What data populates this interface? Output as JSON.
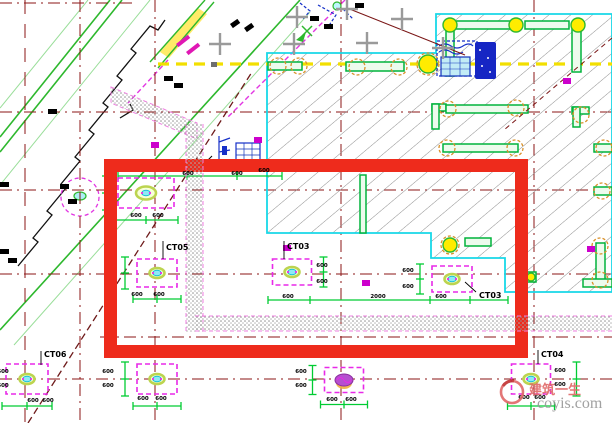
{
  "title": "Foundation pile-cap CAD plan with red highlight box",
  "watermark": {
    "cn": "建筑一生",
    "en": "coyis.com"
  },
  "colors": {
    "grid_line": "#8b1515",
    "highlight_red": "#ee2b1c",
    "wall_green": "#00b33c",
    "dim_green": "#00cc33",
    "boundary_cyan": "#17d8e8",
    "pile_magenta": "#e829e8",
    "hatch_gray": "#8f8f8f",
    "joint_yellow": "#ffec00",
    "circle_orange": "#d9912b",
    "annotation_blue": "#1630c8",
    "axis_yellow": "#f2df00",
    "strip_magenta": "#ef7fe0",
    "diag_green": "#2eb82e",
    "watermark_red": "#e06868",
    "watermark_gray": "#979797"
  },
  "grid": {
    "verticals": [
      {
        "x": 25,
        "dash": "14 10"
      },
      {
        "x": 80
      },
      {
        "x": 155
      },
      {
        "x": 341
      },
      {
        "x": 534
      }
    ],
    "horizontals": [
      {
        "y": 3,
        "x1": 0,
        "x2": 135
      },
      {
        "y": 112,
        "x1": 0,
        "x2": 612
      },
      {
        "y": 190,
        "x1": 0,
        "x2": 612
      },
      {
        "y": 274,
        "x1": 0,
        "x2": 612
      },
      {
        "y": 337,
        "x1": 100,
        "x2": 612
      },
      {
        "y": 379,
        "x1": 0,
        "x2": 612
      }
    ]
  },
  "structures": {
    "walls": [
      [
        446,
        30,
        8,
        46
      ],
      [
        455,
        21,
        56,
        8
      ],
      [
        525,
        21,
        44,
        8
      ],
      [
        572,
        28,
        9,
        44
      ],
      [
        346,
        62,
        58,
        9
      ],
      [
        268,
        62,
        34,
        8
      ],
      [
        432,
        104,
        14,
        7
      ],
      [
        432,
        104,
        7,
        25
      ],
      [
        446,
        105,
        82,
        8
      ],
      [
        572,
        107,
        17,
        7
      ],
      [
        573,
        107,
        7,
        20
      ],
      [
        443,
        144,
        75,
        8
      ],
      [
        594,
        144,
        18,
        8
      ],
      [
        594,
        187,
        18,
        8
      ],
      [
        596,
        243,
        9,
        38
      ],
      [
        583,
        279,
        29,
        8
      ],
      [
        526,
        272,
        10,
        10
      ],
      [
        360,
        175,
        6,
        58
      ],
      [
        465,
        238,
        26,
        8
      ]
    ],
    "yellow_joints": [
      [
        450,
        25,
        7
      ],
      [
        516,
        25,
        7
      ],
      [
        578,
        25,
        7
      ],
      [
        428,
        64,
        9
      ],
      [
        450,
        245,
        7
      ],
      [
        531,
        277,
        4
      ]
    ],
    "orange_circles": [
      [
        278,
        66,
        8
      ],
      [
        299,
        66,
        8
      ],
      [
        357,
        67,
        8
      ],
      [
        399,
        67,
        8
      ],
      [
        428,
        64,
        11
      ],
      [
        448,
        109,
        8
      ],
      [
        516,
        108,
        8
      ],
      [
        581,
        115,
        8
      ],
      [
        447,
        148,
        8
      ],
      [
        515,
        148,
        8
      ],
      [
        604,
        148,
        8
      ],
      [
        602,
        191,
        8
      ],
      [
        600,
        246,
        8
      ],
      [
        600,
        280,
        8
      ],
      [
        450,
        245,
        9
      ]
    ]
  },
  "pile_caps": [
    {
      "cx": 146,
      "cy": 193,
      "w": 56,
      "h": 30,
      "style": "rings",
      "big": true,
      "bracket": "left",
      "below": true
    },
    {
      "cx": 157,
      "cy": 273,
      "w": 40,
      "h": 28,
      "style": "rings",
      "bracket": "left",
      "below": true
    },
    {
      "cx": 292,
      "cy": 272,
      "w": 39,
      "h": 26,
      "style": "rings",
      "bracket": "right",
      "below": false
    },
    {
      "cx": 452,
      "cy": 279,
      "w": 40,
      "h": 26,
      "style": "rings",
      "bracket": "left",
      "below": false
    },
    {
      "cx": 27,
      "cy": 379,
      "w": 42,
      "h": 30,
      "style": "rings",
      "bracket": "left",
      "below": true
    },
    {
      "cx": 157,
      "cy": 379,
      "w": 40,
      "h": 30,
      "style": "rings",
      "bracket": "left",
      "below": true
    },
    {
      "cx": 344,
      "cy": 380,
      "w": 39,
      "h": 25,
      "style": "scribble",
      "bracket": "left",
      "below": true
    },
    {
      "cx": 531,
      "cy": 379,
      "w": 39,
      "h": 30,
      "style": "rings",
      "bracket": "right",
      "boff": 26,
      "below": true
    }
  ],
  "cap_labels": [
    {
      "text": "CT05",
      "x": 166,
      "y": 250,
      "l": [
        163,
        241,
        163,
        259
      ]
    },
    {
      "text": "CT03",
      "x": 287,
      "y": 249,
      "l": [
        284,
        241,
        284,
        259
      ]
    },
    {
      "text": "CT03",
      "x": 479,
      "y": 298,
      "l": [
        465,
        282,
        476,
        292
      ]
    },
    {
      "text": "CT06",
      "x": 44,
      "y": 357,
      "l": [
        41,
        351,
        41,
        365
      ]
    },
    {
      "text": "CT04",
      "x": 541,
      "y": 357,
      "l": [
        538,
        350,
        538,
        364
      ]
    }
  ],
  "dimension_lines": [
    {
      "y": 300,
      "x1": 268,
      "x2": 508,
      "ticks": [
        268,
        310,
        430,
        470,
        508
      ]
    },
    {
      "y": 176,
      "x1": 118,
      "x2": 282,
      "ticks": [
        118,
        187,
        237,
        282
      ]
    }
  ],
  "dimension_texts": [
    {
      "v": "600",
      "x": 136,
      "y": 217
    },
    {
      "v": "600",
      "x": 158,
      "y": 217
    },
    {
      "v": "600",
      "x": 188,
      "y": 175
    },
    {
      "v": "600",
      "x": 237,
      "y": 175
    },
    {
      "v": "600",
      "x": 264,
      "y": 172
    },
    {
      "v": "600",
      "x": 137,
      "y": 296
    },
    {
      "v": "600",
      "x": 159,
      "y": 296
    },
    {
      "v": "600",
      "x": 322,
      "y": 267
    },
    {
      "v": "600",
      "x": 322,
      "y": 283
    },
    {
      "v": "600",
      "x": 288,
      "y": 298
    },
    {
      "v": "2000",
      "x": 378,
      "y": 298
    },
    {
      "v": "600",
      "x": 441,
      "y": 298
    },
    {
      "v": "600",
      "x": 408,
      "y": 272
    },
    {
      "v": "600",
      "x": 408,
      "y": 288
    },
    {
      "v": "600",
      "x": 33,
      "y": 402
    },
    {
      "v": "600",
      "x": 48,
      "y": 402
    },
    {
      "v": "600",
      "x": 3,
      "y": 373
    },
    {
      "v": "600",
      "x": 3,
      "y": 387
    },
    {
      "v": "600",
      "x": 143,
      "y": 400
    },
    {
      "v": "600",
      "x": 161,
      "y": 400
    },
    {
      "v": "600",
      "x": 108,
      "y": 373
    },
    {
      "v": "600",
      "x": 108,
      "y": 387
    },
    {
      "v": "600",
      "x": 332,
      "y": 401
    },
    {
      "v": "600",
      "x": 351,
      "y": 401
    },
    {
      "v": "600",
      "x": 301,
      "y": 373
    },
    {
      "v": "600",
      "x": 301,
      "y": 387
    },
    {
      "v": "600",
      "x": 524,
      "y": 399
    },
    {
      "v": "600",
      "x": 540,
      "y": 399
    },
    {
      "v": "600",
      "x": 560,
      "y": 372
    },
    {
      "v": "600",
      "x": 560,
      "y": 386
    }
  ],
  "plus_markers": [
    [
      220,
      44
    ],
    [
      294,
      44
    ],
    [
      297,
      17
    ],
    [
      367,
      43
    ],
    [
      402,
      19
    ],
    [
      347,
      9
    ],
    [
      443,
      48
    ]
  ],
  "magenta_squares": [
    [
      151,
      142
    ],
    [
      563,
      78
    ],
    [
      283,
      245
    ],
    [
      362,
      280
    ],
    [
      587,
      246
    ],
    [
      254,
      137
    ]
  ],
  "misc_blobs": [
    {
      "x": 48,
      "y": 109
    },
    {
      "x": 164,
      "y": 76
    },
    {
      "x": 174,
      "y": 83
    },
    {
      "x": 60,
      "y": 184
    },
    {
      "x": 68,
      "y": 199
    },
    {
      "x": 0,
      "y": 182
    },
    {
      "x": 0,
      "y": 249
    },
    {
      "x": 8,
      "y": 258
    },
    {
      "x": 230,
      "y": 24,
      "r": -35
    },
    {
      "x": 244,
      "y": 28,
      "r": -35
    },
    {
      "x": 310,
      "y": 16
    },
    {
      "x": 324,
      "y": 24
    },
    {
      "x": 355,
      "y": 3
    },
    {
      "x": 211,
      "y": 62,
      "c": "#6e6e6e",
      "w": 6,
      "h": 5
    },
    {
      "x": 176,
      "y": 44,
      "r": -38,
      "c": "#e018b4",
      "w": 15,
      "h": 4
    },
    {
      "x": 186,
      "y": 52,
      "r": -38,
      "c": "#e018b4",
      "w": 15,
      "h": 4
    }
  ],
  "ruler_marks": [
    [
      105,
      184
    ],
    [
      105,
      190
    ],
    [
      105,
      196
    ],
    [
      105,
      202
    ]
  ]
}
